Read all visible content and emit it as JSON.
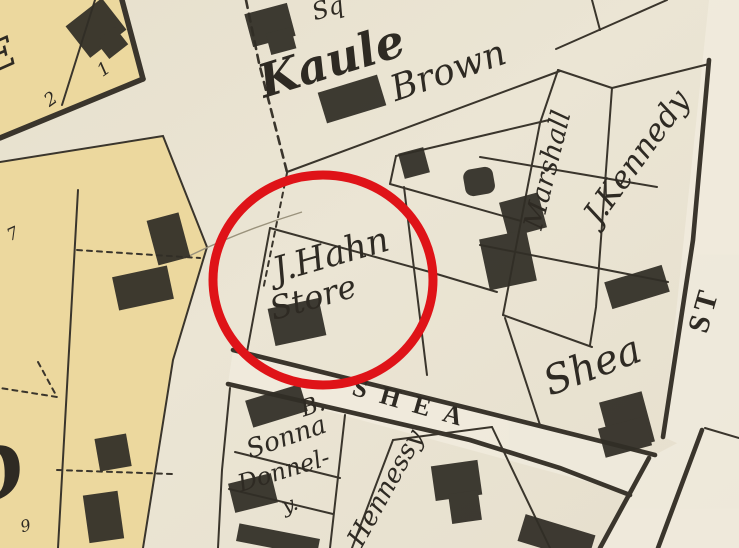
{
  "map": {
    "type": "historic-plat-map",
    "annotation": {
      "shape": "circle",
      "purpose": "highlight of J.Hahn Store parcel",
      "color": "#df1318"
    },
    "colors": {
      "paper": "#e9e3d2",
      "parcel_yellow": "#ecd89e",
      "street_light": "#f1ecdf",
      "ink": "#39342c",
      "building_ink": "#322e27",
      "label_ink": "#2e2a23",
      "highlight_red": "#df1318"
    },
    "labels": {
      "partial_top": "Sq",
      "kaule": "Kaule",
      "brown": "Brown",
      "hahn_line1": "J.Hahn",
      "hahn_line2": "Store",
      "marshall": "Marshall",
      "kennedy": "J.Kennedy",
      "st_street": "ST",
      "shea_owner": "Shea",
      "shea_street": "SHEA",
      "b_initial": "B.",
      "sonna": "Sonna",
      "donnelly_line1": "Donnel-",
      "donnelly_line2": "y.",
      "hennessy": "Hennessy",
      "lot_7": "7",
      "lot_2": "2",
      "lot_1": "1",
      "lot_9": "9",
      "d_partial": "D",
      "e_partial": "E"
    }
  }
}
